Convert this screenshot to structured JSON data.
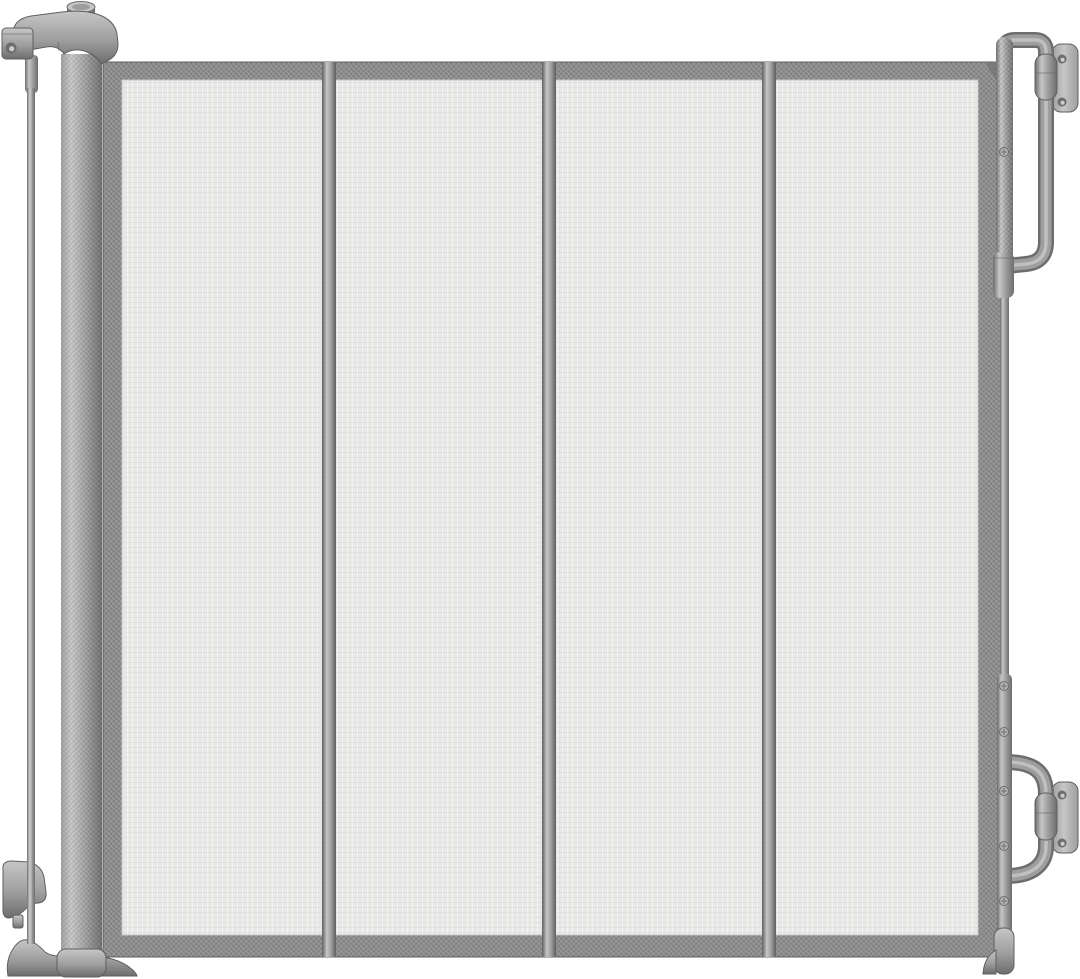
{
  "image": {
    "subject": "Gray retractable mesh safety gate, front product view on white background",
    "type": "product-photo",
    "text_visible": "none"
  },
  "colors": {
    "background": "#ffffff",
    "mesh": "#e8e8e7",
    "meshLight": "#f5f5f5",
    "meshDark": "#dadada",
    "strap": "#8e8e8e",
    "strapDark": "#7a7a7a",
    "strapLight": "#9e9e9e",
    "metalLight": "#c6c6c6",
    "metalMid": "#9e9e9e",
    "metalDark": "#6d6d6d",
    "edge": "#5f5f5f"
  },
  "structure": {
    "mesh_panels": 4,
    "divider_bars": 3,
    "wall_plates": 2,
    "screw_holes_per_plate": 2,
    "visible_screws_on_latch_bar": 6
  },
  "parts": {
    "roller_post": "knurled roller housing post (left)",
    "lock_head": "rotating lock head on top of roller post",
    "lock_knob": "cylindrical knob on lock head",
    "spool_pole": "thin tension pole (far left)",
    "pole_bracket": "upper pole bracket with hole",
    "latch_catch": "latch catch piece near bottom of pole",
    "base_foot": "curved floor foot under post and pole",
    "mesh_panel": "woven mesh gate fabric with strap border",
    "divider_bar": "vertical stiffener bar on mesh",
    "latch_bar": "vertical latch bar (right)",
    "mount_bracket": "U-tube wall mounting bracket with hinge barrel",
    "wall_plate": "wall mounting plate with screw holes",
    "foot_cap": "bottom cap and wedge foot of latch bar"
  }
}
